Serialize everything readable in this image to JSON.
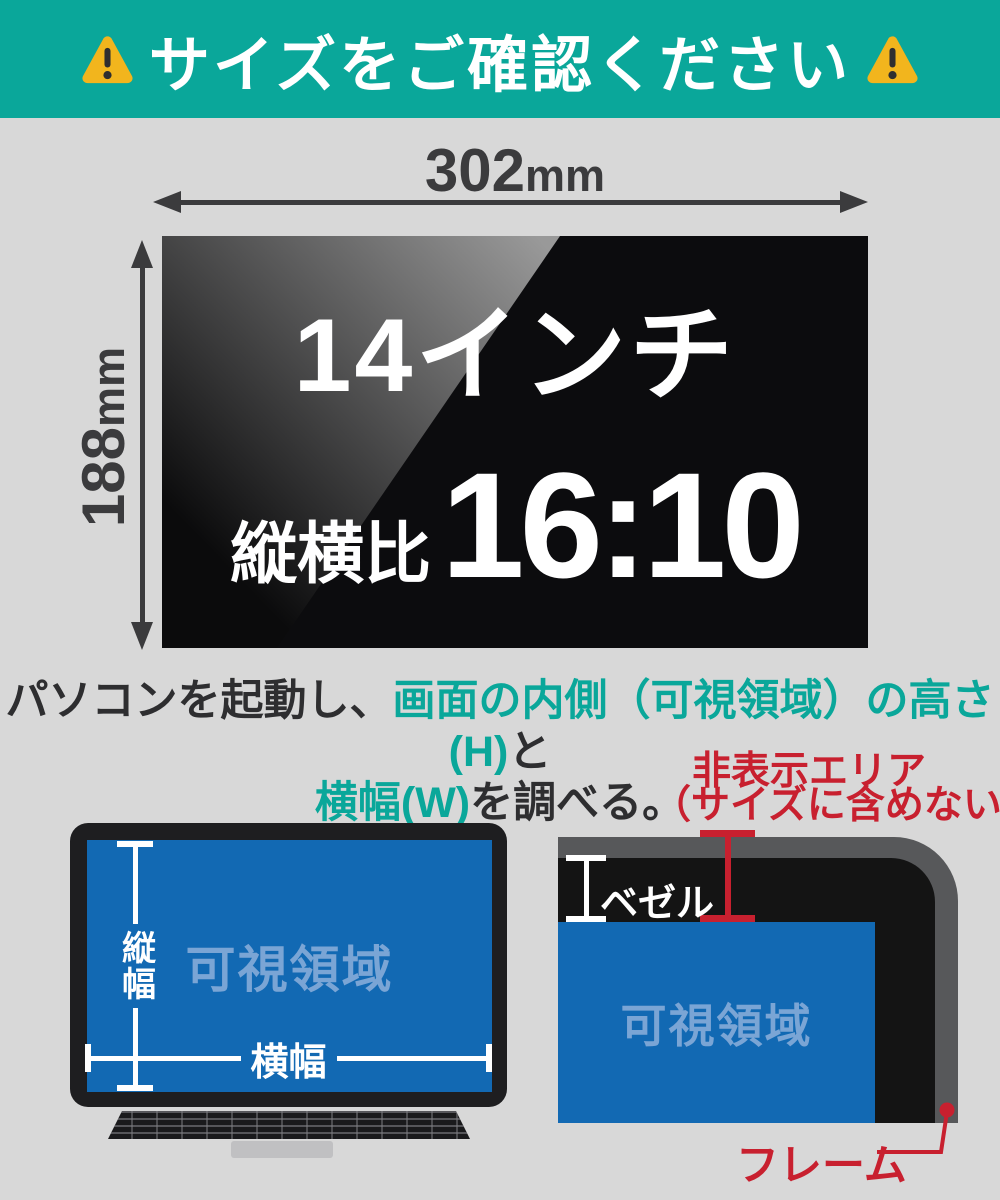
{
  "colors": {
    "teal": "#0AA79A",
    "red": "#C8202F",
    "blue": "#1269B3",
    "lightblue": "#7AA5D5",
    "dim": "#3B3B3D",
    "bg": "#D8D8D8"
  },
  "banner": {
    "title": "サイズをご確認ください",
    "warning_icon": "warning-triangle-icon"
  },
  "dimensions": {
    "width_value": "302",
    "width_unit": "mm",
    "height_value": "188",
    "height_unit": "mm"
  },
  "screen": {
    "size_label": "14インチ",
    "ratio_prefix": "縦横比",
    "ratio_value": "16:10"
  },
  "instruction": {
    "l1_black": "パソコンを起動し、",
    "l1_teal": "画面の内側（可視領域）の高さ(H)",
    "l1_suffix": "と",
    "l2_teal": "横幅(W)",
    "l2_black": "を調べる。"
  },
  "laptop": {
    "visible_area": "可視領域",
    "height_label": "縦幅",
    "width_label": "横幅"
  },
  "corner": {
    "hidden_line1": "非表示エリア",
    "hidden_line2": "（サイズに含めない）",
    "bezel": "ベゼル",
    "visible_area": "可視領域",
    "frame": "フレーム"
  }
}
